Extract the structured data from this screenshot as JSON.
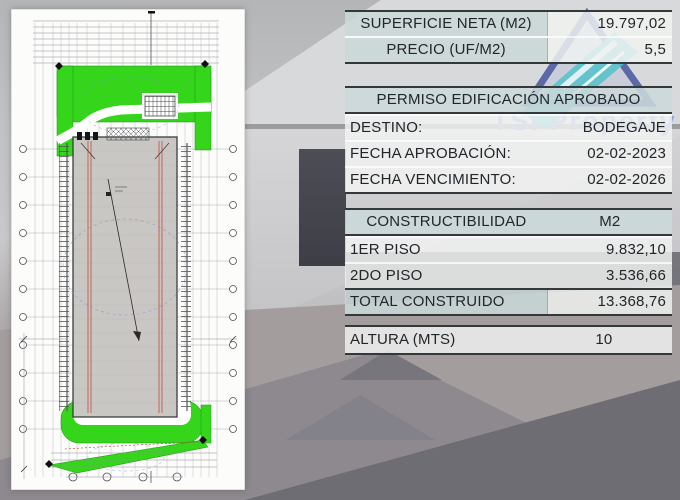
{
  "tables": {
    "summary": {
      "rows": [
        {
          "label": "SUPERFICIE NETA (M2)",
          "value": "19.797,02"
        },
        {
          "label": "PRECIO (UF/M2)",
          "value": "5,5"
        }
      ]
    },
    "permit": {
      "header": "PERMISO EDIFICACIÓN APROBADO",
      "rows": [
        {
          "label": "DESTINO:",
          "value": "BODEGAJE"
        },
        {
          "label": "FECHA APROBACIÓN:",
          "value": "02-02-2023"
        },
        {
          "label": "FECHA VENCIMIENTO:",
          "value": "02-02-2026"
        }
      ]
    },
    "constructibility": {
      "header_label": "CONSTRUCTIBILIDAD",
      "header_unit": "M2",
      "rows": [
        {
          "label": "1ER PISO",
          "value": "9.832,10"
        },
        {
          "label": "2DO PISO",
          "value": "3.536,66"
        }
      ],
      "total": {
        "label": "TOTAL CONSTRUIDO",
        "value": "13.368,76"
      }
    },
    "height": {
      "label": "ALTURA (MTS)",
      "value": "10"
    }
  },
  "watermark": {
    "text": "TSI Property"
  },
  "plan": {
    "description": "warehouse site plan, first floor"
  },
  "colors": {
    "plan_green": "#35d51c",
    "building_gray": "#c8c7c4",
    "table_header_bg": "#ccd8d9",
    "table_row_bg": "#f1f3f1",
    "table_border": "#33383b",
    "watermark_blue": "#8fa2da",
    "watermark_outline": "#5d68a8",
    "watermark_teal": "#55c2cb",
    "column_line_red": "#c0392b"
  }
}
